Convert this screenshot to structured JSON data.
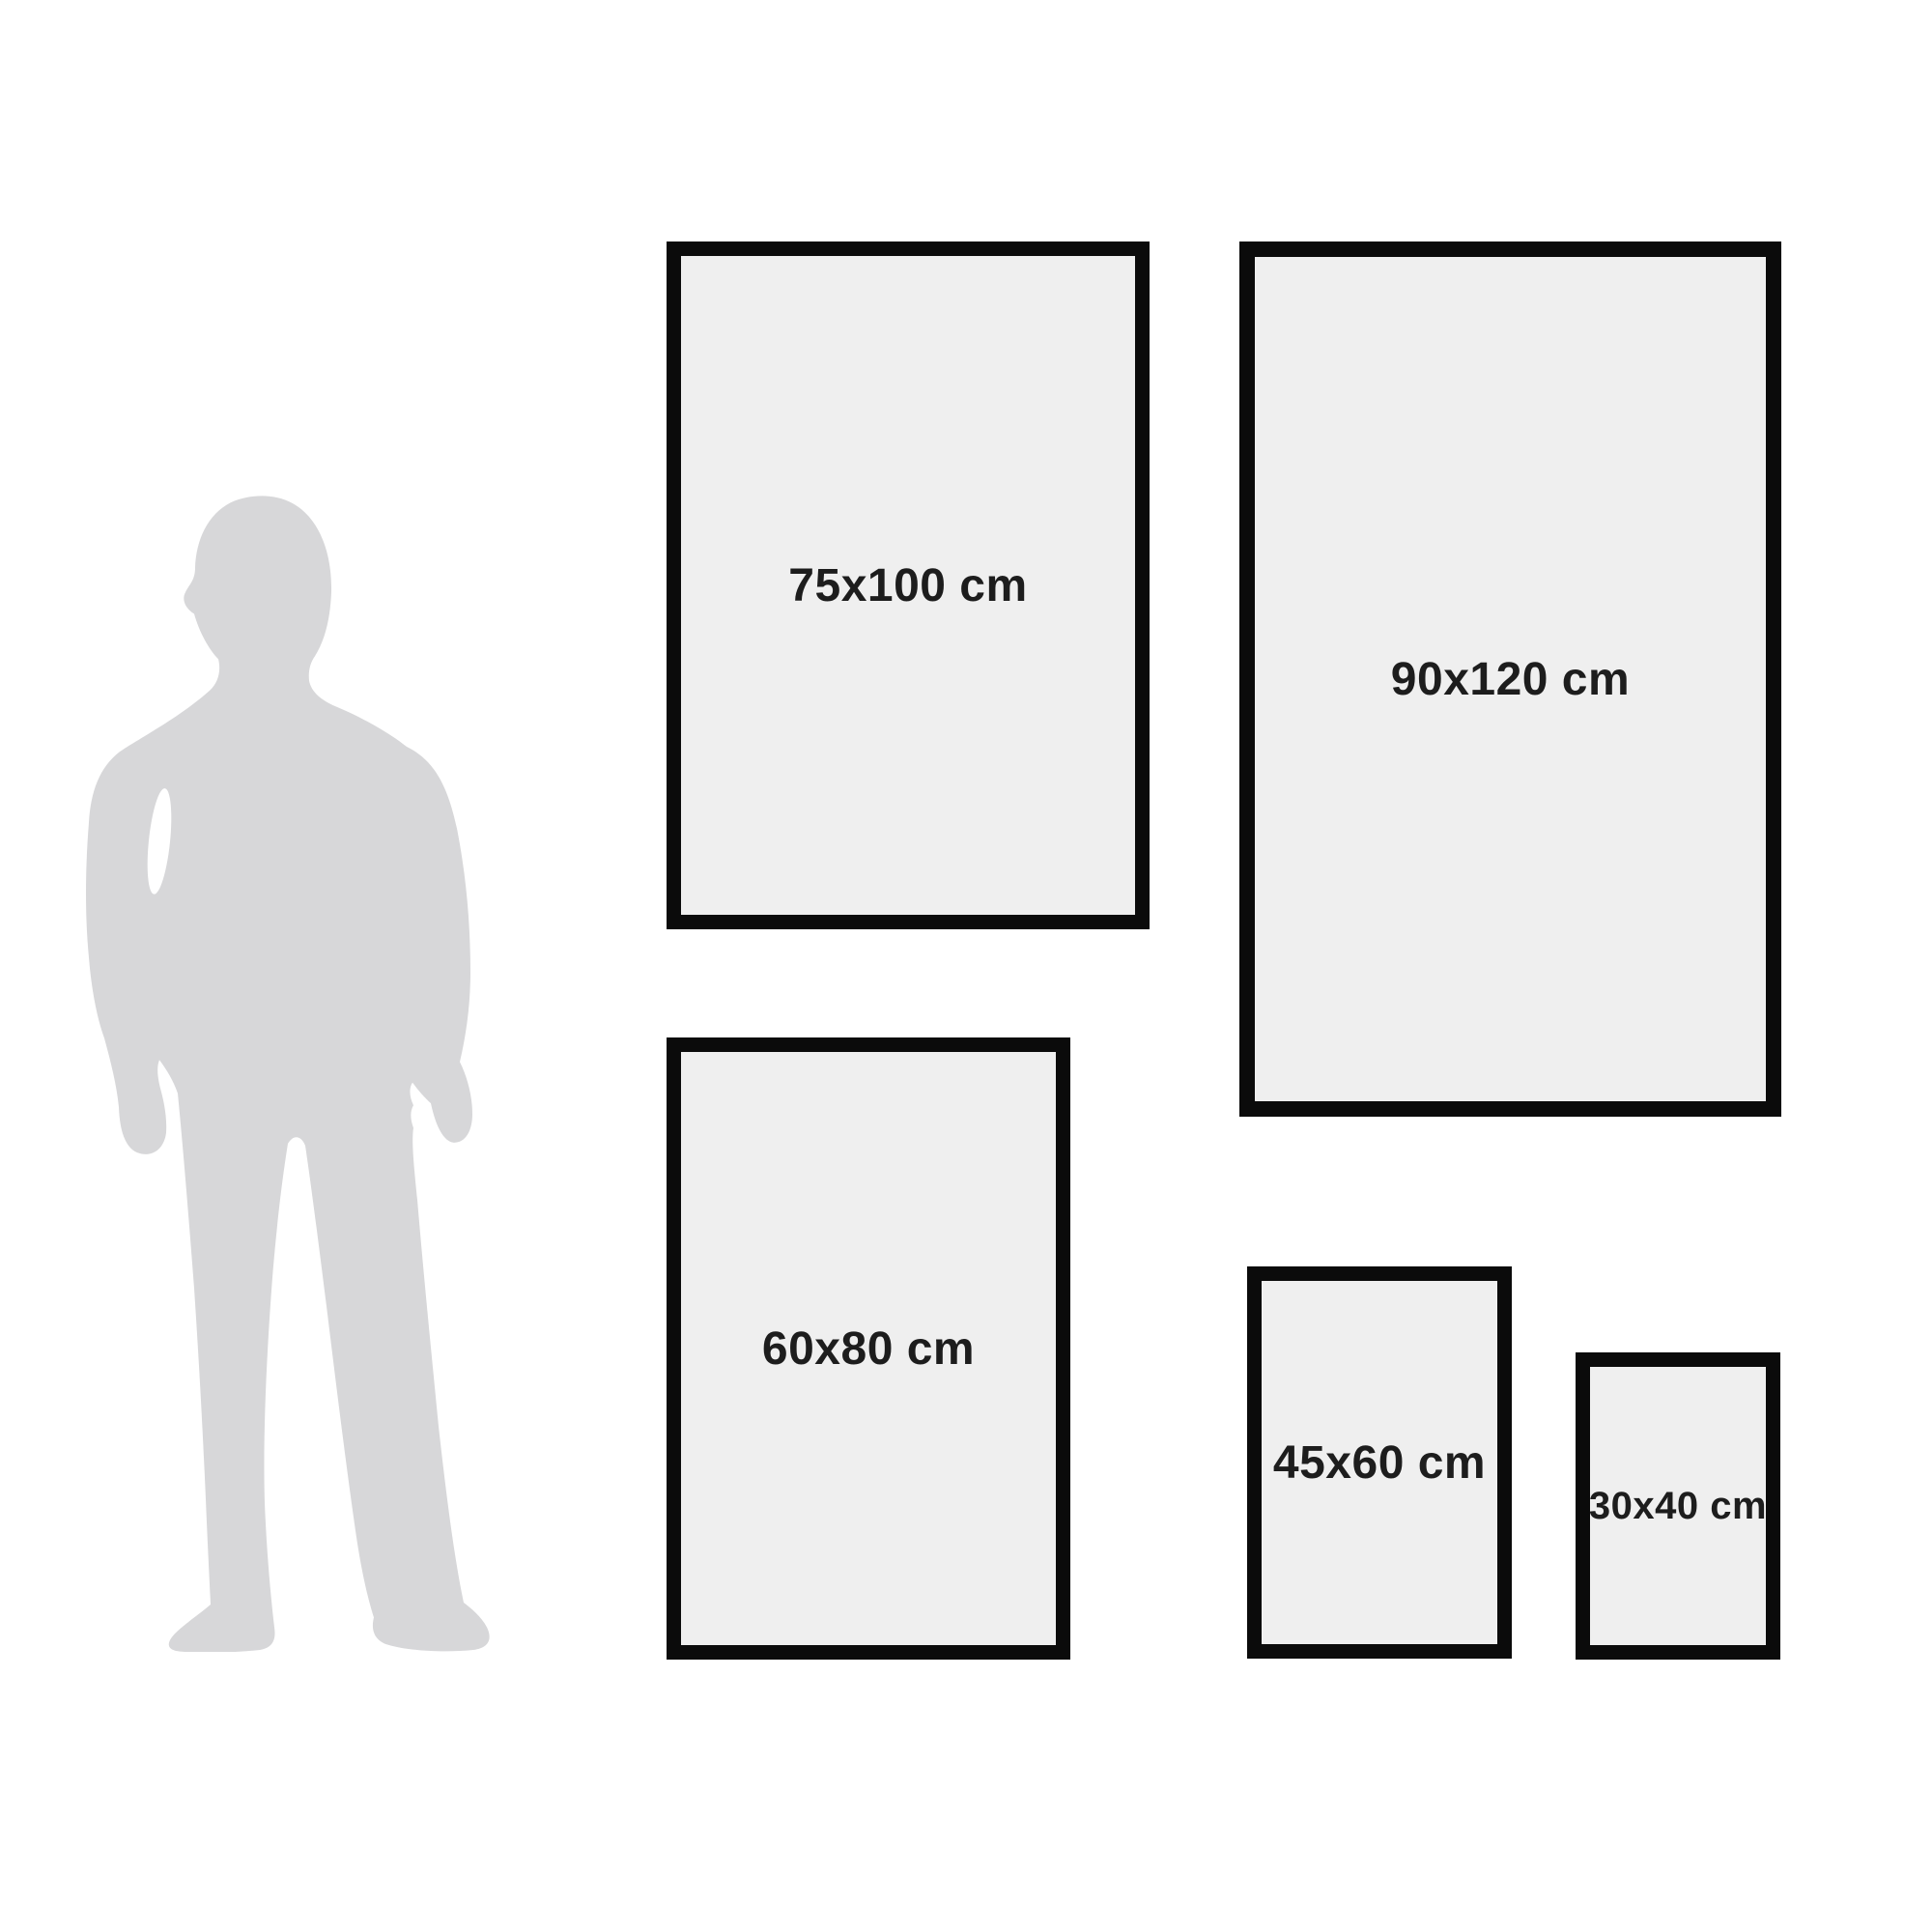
{
  "diagram": {
    "colors": {
      "background": "#ffffff",
      "silhouette": "#d7d7d9",
      "frame_border": "#0b0b0b",
      "frame_fill": "#efefef",
      "label_text": "#1d1d1d"
    },
    "frames": [
      {
        "label": "75x100 cm",
        "width_cm": 75,
        "height_cm": 100
      },
      {
        "label": "90x120 cm",
        "width_cm": 90,
        "height_cm": 120
      },
      {
        "label": "60x80 cm",
        "width_cm": 60,
        "height_cm": 80
      },
      {
        "label": "45x60 cm",
        "width_cm": 45,
        "height_cm": 60
      },
      {
        "label": "30x40 cm",
        "width_cm": 30,
        "height_cm": 40
      }
    ]
  }
}
